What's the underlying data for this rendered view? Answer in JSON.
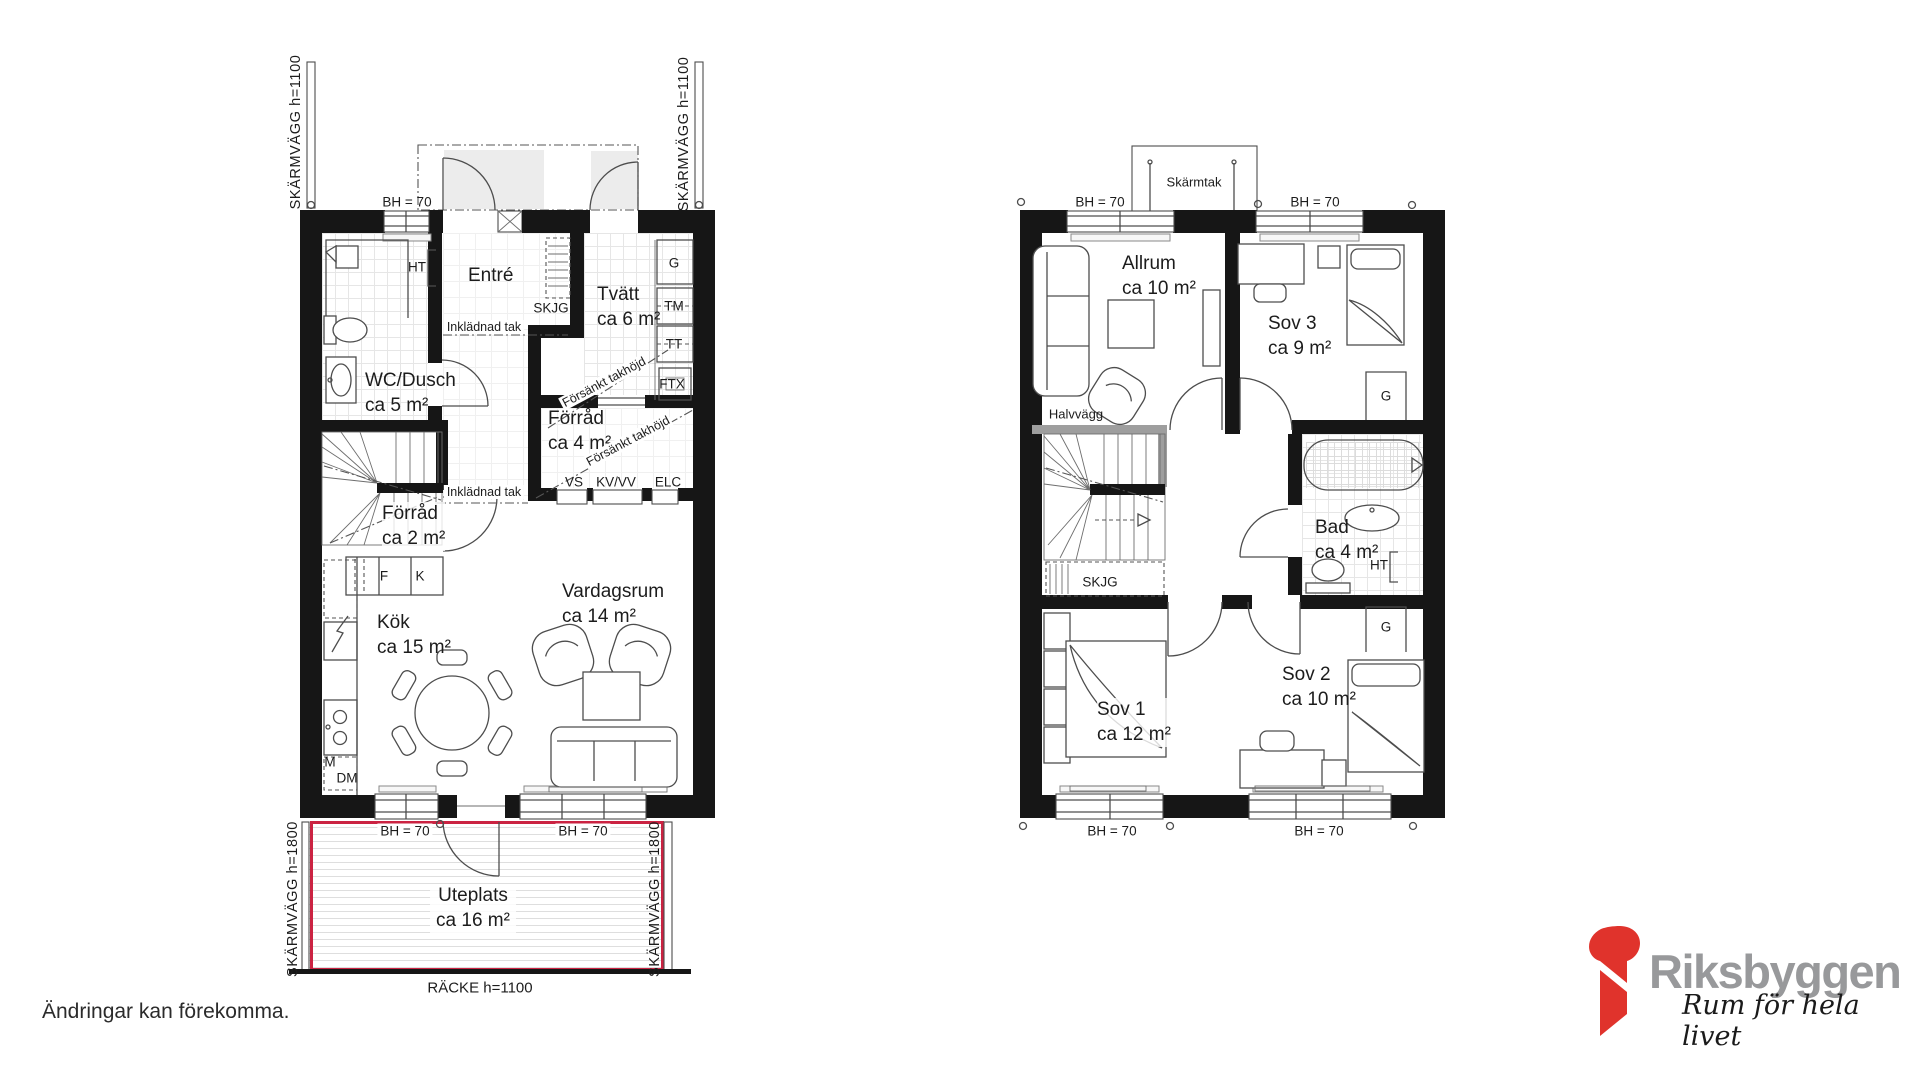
{
  "colors": {
    "wall": "#161616",
    "furniture_line": "#4d4d4d",
    "terrace_outline_red": "#cb2342",
    "logo_red": "#e0332c",
    "logo_gray": "#98999b",
    "half_wall_gray": "#9e9e9e"
  },
  "disclaimer": "Ändringar kan förekomma.",
  "brand": {
    "name": "Riksbyggen",
    "tagline": "Rum för hela livet"
  },
  "shared": {
    "bh70": "BH = 70"
  },
  "floor1": {
    "rooms": {
      "entre": {
        "name": "Entré"
      },
      "wc_dusch": {
        "name": "WC/Dusch",
        "area": "ca 5 m²"
      },
      "tvatt": {
        "name": "Tvätt",
        "area": "ca 6 m²"
      },
      "forrad_4": {
        "name": "Förråd",
        "area": "ca 4 m²"
      },
      "forrad_2": {
        "name": "Förråd",
        "area": "ca 2 m²"
      },
      "kok": {
        "name": "Kök",
        "area": "ca 15 m²"
      },
      "vardagsrum": {
        "name": "Vardagsrum",
        "area": "ca 14 m²"
      },
      "uteplats": {
        "name": "Uteplats",
        "area": "ca 16 m²"
      }
    },
    "labels": {
      "skarmvagg_1100": "SKÄRMVÄGG h=1100",
      "skarmvagg_1800": "SKÄRMVÄGG h=1800",
      "racke_1100": "RÄCKE h=1100",
      "inkladnad_tak": "Inklädnad tak",
      "forsankt_takhojd": "Försänkt takhöjd",
      "skjg": "SKJG",
      "ht": "HT",
      "g": "G",
      "tm": "TM",
      "tt": "TT",
      "ftx": "FTX",
      "vs": "VS",
      "kv_vv": "KV/VV",
      "elc": "ELC",
      "f": "F",
      "k": "K",
      "m": "M",
      "dm": "DM"
    }
  },
  "floor2": {
    "rooms": {
      "allrum": {
        "name": "Allrum",
        "area": "ca 10 m²"
      },
      "sov3": {
        "name": "Sov 3",
        "area": "ca 9 m²"
      },
      "bad": {
        "name": "Bad",
        "area": "ca 4 m²"
      },
      "sov1": {
        "name": "Sov 1",
        "area": "ca 12 m²"
      },
      "sov2": {
        "name": "Sov 2",
        "area": "ca 10 m²"
      }
    },
    "labels": {
      "skarmtak": "Skärmtak",
      "halvvagg": "Halvvägg",
      "skjg": "SKJG",
      "g": "G",
      "ht": "HT"
    }
  }
}
